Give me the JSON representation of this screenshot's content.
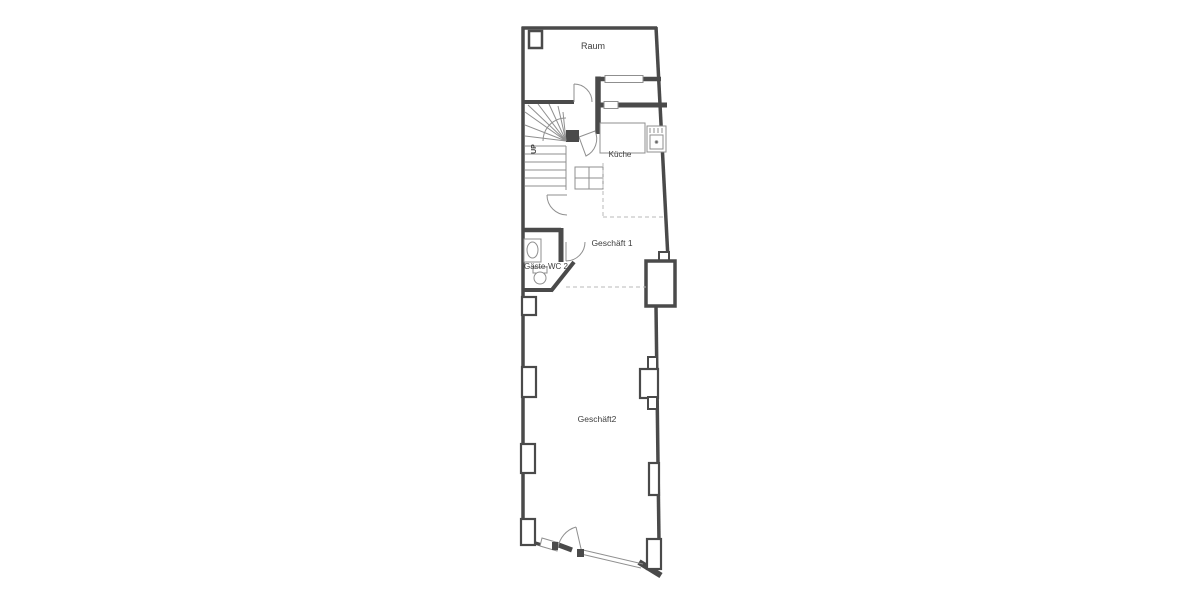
{
  "floor_plan": {
    "colors": {
      "background": "#ffffff",
      "wall": "#4a4a4a",
      "thin": "#8f8f8f",
      "dash": "#b8b8b8",
      "text": "#3d3d3d"
    },
    "labels": {
      "raum": "Raum",
      "kueche": "Küche",
      "geschaeft1": "Geschäft 1",
      "gaeste_wc": "Gäste-WC 2",
      "geschaeft2": "Geschäft2",
      "stairs": "UP"
    }
  }
}
